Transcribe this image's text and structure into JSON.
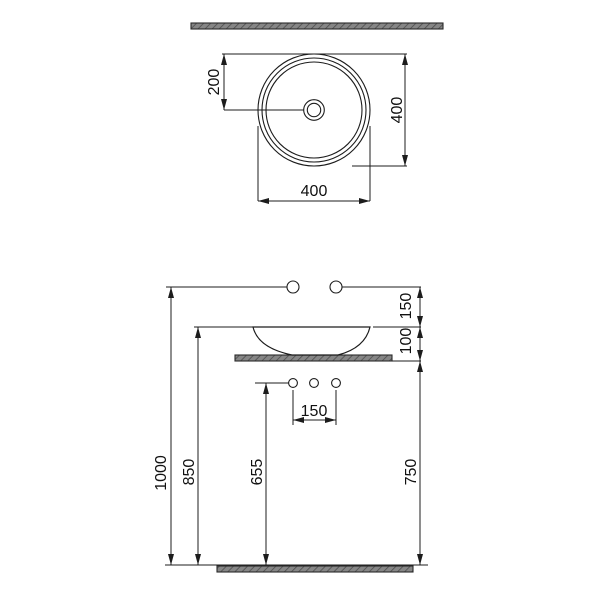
{
  "page": {
    "background": "#ffffff"
  },
  "colors": {
    "line": "#1c1c1c",
    "text": "#111111",
    "section_fill": "#868686",
    "section_hatch": "#4d4d4d",
    "section_border": "#2a2a2a"
  },
  "top_view": {
    "center_offset_label": "200",
    "height_label": "400",
    "width_label": "400"
  },
  "front_view": {
    "faucet_to_rim_label": "150",
    "rim_to_countertop_label": "100",
    "holes_spacing_label": "150",
    "total_height_label": "1000",
    "rim_height_label": "850",
    "holes_height_label": "655",
    "countertop_height_label": "750"
  }
}
